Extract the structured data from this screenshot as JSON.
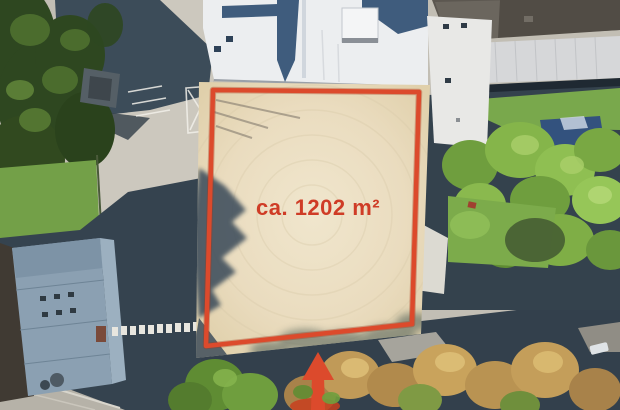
{
  "meta": {
    "type": "aerial-drone-photo",
    "description": "Top-down aerial photograph of a vacant sand lot between school buildings, marked with a red boundary polygon, an area label and a red access arrow from the street"
  },
  "annotation": {
    "area_label": "ca. 1202 m²",
    "accent_color": "#dc4a2c",
    "accent_dark": "#a63418",
    "label_color": "#cf3c26"
  },
  "scene": {
    "palette": {
      "sand": "#ebdfc4",
      "asphalt": "#c2beb4",
      "shadow_blue": "#36454f",
      "grass": "#73a048",
      "tree_dark": "#2e4720",
      "tree_bright": "#85b54a",
      "tree_autumn": "#c09a58",
      "roof_white": "#eceef0",
      "roof_gray": "#5c5750",
      "roof_light_band": "#d6d7d9",
      "roof_blue_gray": "#8ba0b2",
      "shed_blue": "#33527e",
      "street": "#b6b2a8"
    }
  }
}
